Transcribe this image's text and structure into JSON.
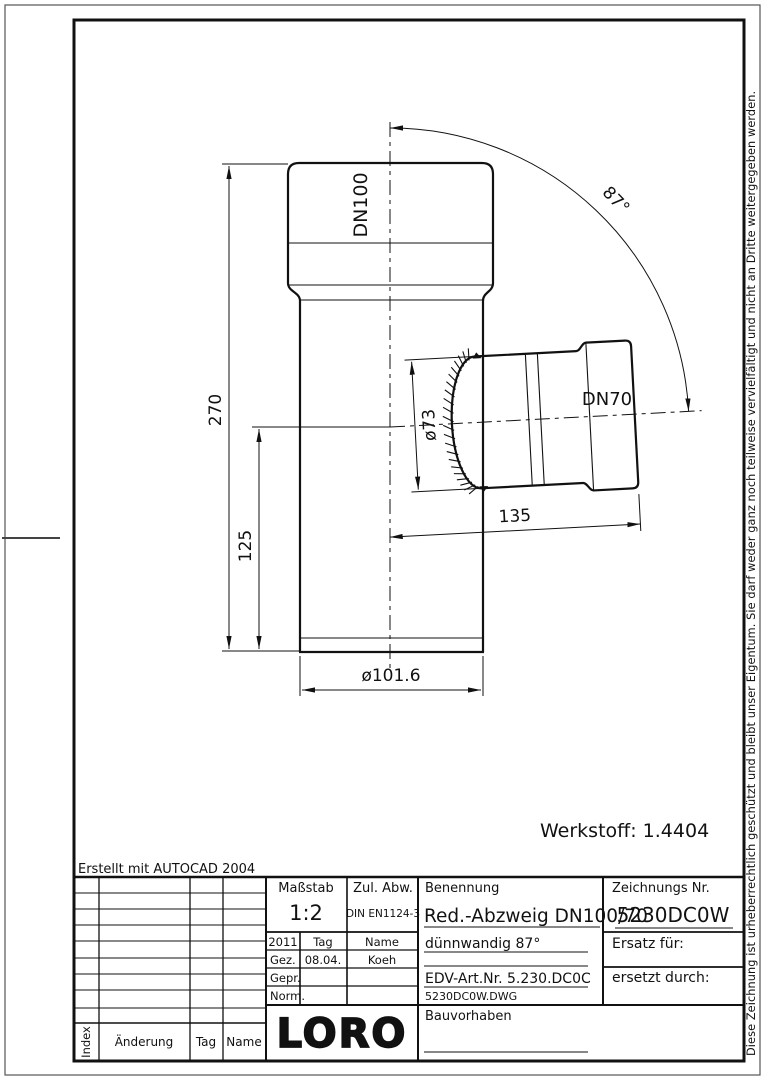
{
  "page": {
    "erstellt": "Erstellt mit AUTOCAD 2004",
    "disclaimer": "Diese Zeichnung ist urheberrechtlich geschützt und bleibt unser Eigentum. Sie darf weder ganz noch teilweise vervielfältigt und nicht an Dritte weitergegeben werden."
  },
  "drawing": {
    "werkstoff": "Werkstoff:  1.4404",
    "labels": {
      "dn_main": "DN100",
      "dn_branch": "DN70"
    },
    "dims": {
      "total_height": "270",
      "branch_height": "125",
      "branch_weld_dia": "ø73",
      "branch_length": "135",
      "main_dia": "ø101.6",
      "angle": "87°"
    }
  },
  "titleblock": {
    "massstab_label": "Maßstab",
    "massstab_value": "1:2",
    "zul_abw_label": "Zul. Abw.",
    "zul_abw_value": "DIN EN1124-3",
    "benennung_label": "Benennung",
    "benennung_value": "Red.-Abzweig DN100/70",
    "subtitle": "dünnwandig 87°",
    "edv": "EDV-Art.Nr.  5.230.DC0C",
    "dwg_file": "5230DC0W.DWG",
    "zeichnungs_label": "Zeichnungs Nr.",
    "zeichnungs_value": "5230DC0W",
    "ersatz_label": "Ersatz für:",
    "ersetzt_label": "ersetzt durch:",
    "bauvorhaben_label": "Bauvorhaben",
    "logo": "LORO",
    "rev": {
      "year": "2011",
      "tag_col": "Tag",
      "name_col": "Name",
      "gez_label": "Gez.",
      "gez_date": "08.04.",
      "gez_name": "Koeh",
      "gepr_label": "Gepr.",
      "norm_label": "Norm."
    },
    "index_header": {
      "index": "Index",
      "aenderung": "Änderung",
      "tag": "Tag",
      "name": "Name"
    }
  }
}
